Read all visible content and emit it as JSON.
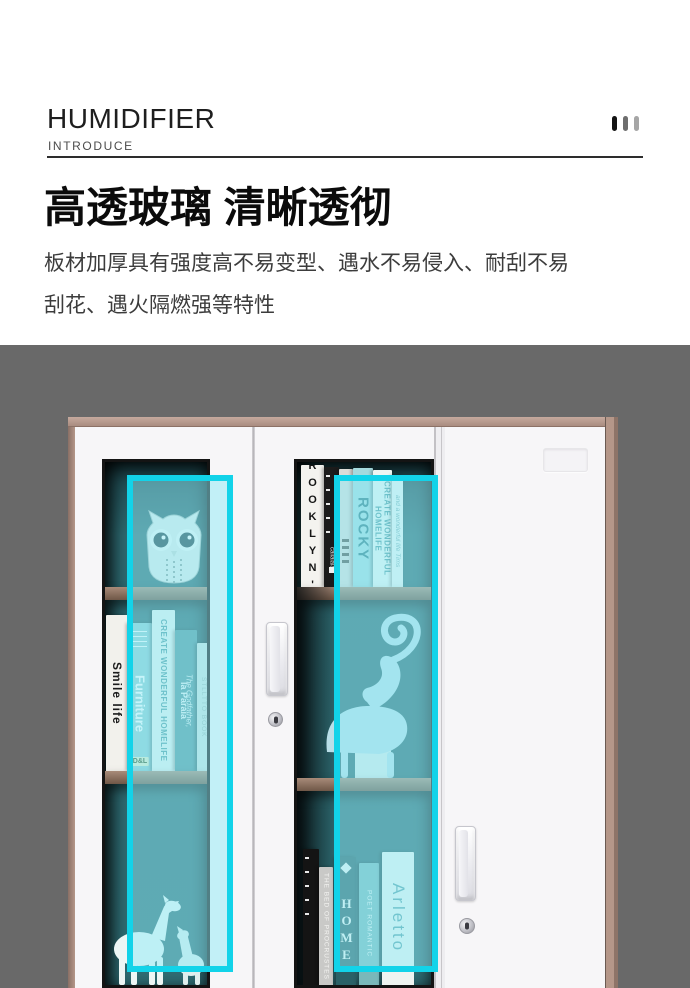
{
  "header": {
    "title": "HUMIDIFIER",
    "subtitle": "INTRODUCE",
    "decor_bar_colors": [
      "#141414",
      "#6e6e6e",
      "#a6a6a6"
    ]
  },
  "intro": {
    "heading": "高透玻璃 清晰透彻",
    "body": "板材加厚具有强度高不易变型、遇水不易侵入、耐刮不易\n刮花、遇火隔燃强等特性"
  },
  "colors": {
    "page_bg": "#ffffff",
    "photo_bg": "#696969",
    "cabinet_trim": "#b29488",
    "door_white": "#f7f6f8",
    "glass_teal": "#2e6a71",
    "shelf_wood": "#8d7364",
    "highlight_border": "#12d3e9",
    "highlight_fill": "rgba(141,233,245,0.5)"
  },
  "product": {
    "left_door": {
      "top_shelf_item": "owl-figurine",
      "bottom_shelf_item": "horse-figurines",
      "books": [
        {
          "title": "Smile life",
          "spine": "#f2f1ec"
        },
        {
          "title": "Furniture",
          "brand": "D&L",
          "spine": "#8fccd1"
        },
        {
          "title": "CREATE WONDERFUL HOMELIFE",
          "spine": "#e9f3ef"
        },
        {
          "title": "la Paraia",
          "subtitle": "The Godfather,",
          "spine": "#53969d"
        },
        {
          "title": "STLLTTO BOOK",
          "spine": "#cfe3df"
        }
      ]
    },
    "middle_door": {
      "middle_shelf_item": "deer-figurine",
      "top_books": [
        {
          "title": "BROOKLYN'S",
          "spine": "#f4f3ef"
        },
        {
          "title": "callalala",
          "spine": "#1b1b1b"
        },
        {
          "title": "",
          "spine": "#dcdcd8"
        },
        {
          "title": "ROCKY",
          "spine": "#a5dade"
        },
        {
          "title": "CREATE WONDERFUL HOMELIFE",
          "spine": "#eef6f3"
        },
        {
          "title": "and a wonderful life Tims",
          "spine": "#f0f5f2"
        }
      ],
      "bottom_books": [
        {
          "title": "",
          "spine": "#141414"
        },
        {
          "title": "THE BED OF PROCRUSTES",
          "spine": "#c9c9c7"
        },
        {
          "title": "HOME",
          "spine": "#2a6167"
        },
        {
          "title": "POET ROMANTIC",
          "spine": "#79b8ba"
        },
        {
          "title": "Arletto",
          "spine": "#eef4f1"
        }
      ]
    },
    "right_door": {
      "hardware": [
        "label-plate",
        "recessed-handle",
        "keyhole-lock"
      ]
    },
    "highlighted_areas": [
      "left-door-glass",
      "middle-door-glass"
    ]
  }
}
